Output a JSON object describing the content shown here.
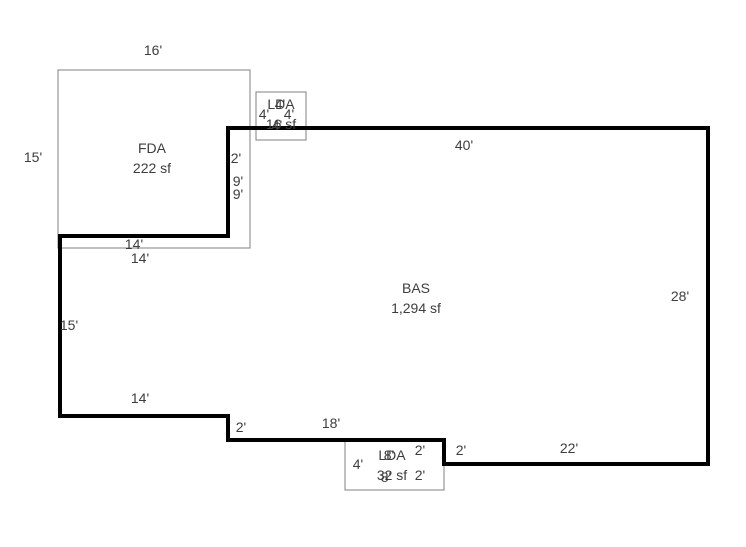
{
  "canvas": {
    "width": 746,
    "height": 547,
    "background": "#ffffff"
  },
  "style": {
    "heavy_line_color": "#000000",
    "thin_line_color": "#808080",
    "text_color": "#3d3d3d",
    "heavy_line_width": 4,
    "thin_line_width": 1
  },
  "areas": [
    {
      "id": "fda",
      "code": "FDA",
      "sqft": "222 sf",
      "x": 152,
      "y": 148
    },
    {
      "id": "bas",
      "code": "BAS",
      "sqft": "1,294 sf",
      "x": 416,
      "y": 288
    },
    {
      "id": "lda-top",
      "code": "LDA",
      "sqft": "16 sf",
      "x": 281,
      "y": 104
    },
    {
      "id": "lda-bottom",
      "code": "LDA",
      "sqft": "32 sf",
      "x": 392,
      "y": 455
    }
  ],
  "shapes": [
    {
      "name": "fda-outline",
      "type": "rect",
      "stroke": "thin",
      "x": 58,
      "y": 70,
      "w": 192,
      "h": 178
    },
    {
      "name": "lda-top-outline",
      "type": "rect",
      "stroke": "thin",
      "x": 256,
      "y": 92,
      "w": 50,
      "h": 48
    },
    {
      "name": "lda-bottom-outline",
      "type": "rect",
      "stroke": "thin",
      "x": 345,
      "y": 440,
      "w": 99,
      "h": 50
    },
    {
      "name": "bas-outline",
      "type": "polygon",
      "stroke": "heavy",
      "points": [
        [
          228,
          128
        ],
        [
          708,
          128
        ],
        [
          708,
          464
        ],
        [
          444,
          464
        ],
        [
          444,
          440
        ],
        [
          228,
          440
        ],
        [
          228,
          416
        ],
        [
          60,
          416
        ],
        [
          60,
          236
        ],
        [
          228,
          236
        ]
      ]
    }
  ],
  "dimensions": [
    {
      "label": "16'",
      "x": 153,
      "y": 50
    },
    {
      "label": "15'",
      "x": 33,
      "y": 157
    },
    {
      "label": "4'",
      "x": 280,
      "y": 104
    },
    {
      "label": "4'",
      "x": 264,
      "y": 114
    },
    {
      "label": "4'",
      "x": 289,
      "y": 114
    },
    {
      "label": "4'",
      "x": 277,
      "y": 125
    },
    {
      "label": "2'",
      "x": 236,
      "y": 158
    },
    {
      "label": "9'",
      "x": 238,
      "y": 181
    },
    {
      "label": "9'",
      "x": 238,
      "y": 194
    },
    {
      "label": "40'",
      "x": 464,
      "y": 145
    },
    {
      "label": "14'",
      "x": 134,
      "y": 244
    },
    {
      "label": "14'",
      "x": 140,
      "y": 258
    },
    {
      "label": "28'",
      "x": 680,
      "y": 296
    },
    {
      "label": "15'",
      "x": 69,
      "y": 325
    },
    {
      "label": "14'",
      "x": 140,
      "y": 398
    },
    {
      "label": "2'",
      "x": 241,
      "y": 427
    },
    {
      "label": "18'",
      "x": 331,
      "y": 423
    },
    {
      "label": "4'",
      "x": 358,
      "y": 464
    },
    {
      "label": "8'",
      "x": 389,
      "y": 455
    },
    {
      "label": "8'",
      "x": 386,
      "y": 477
    },
    {
      "label": "2'",
      "x": 420,
      "y": 450
    },
    {
      "label": "2'",
      "x": 420,
      "y": 475
    },
    {
      "label": "2'",
      "x": 461,
      "y": 450
    },
    {
      "label": "22'",
      "x": 569,
      "y": 448
    }
  ]
}
